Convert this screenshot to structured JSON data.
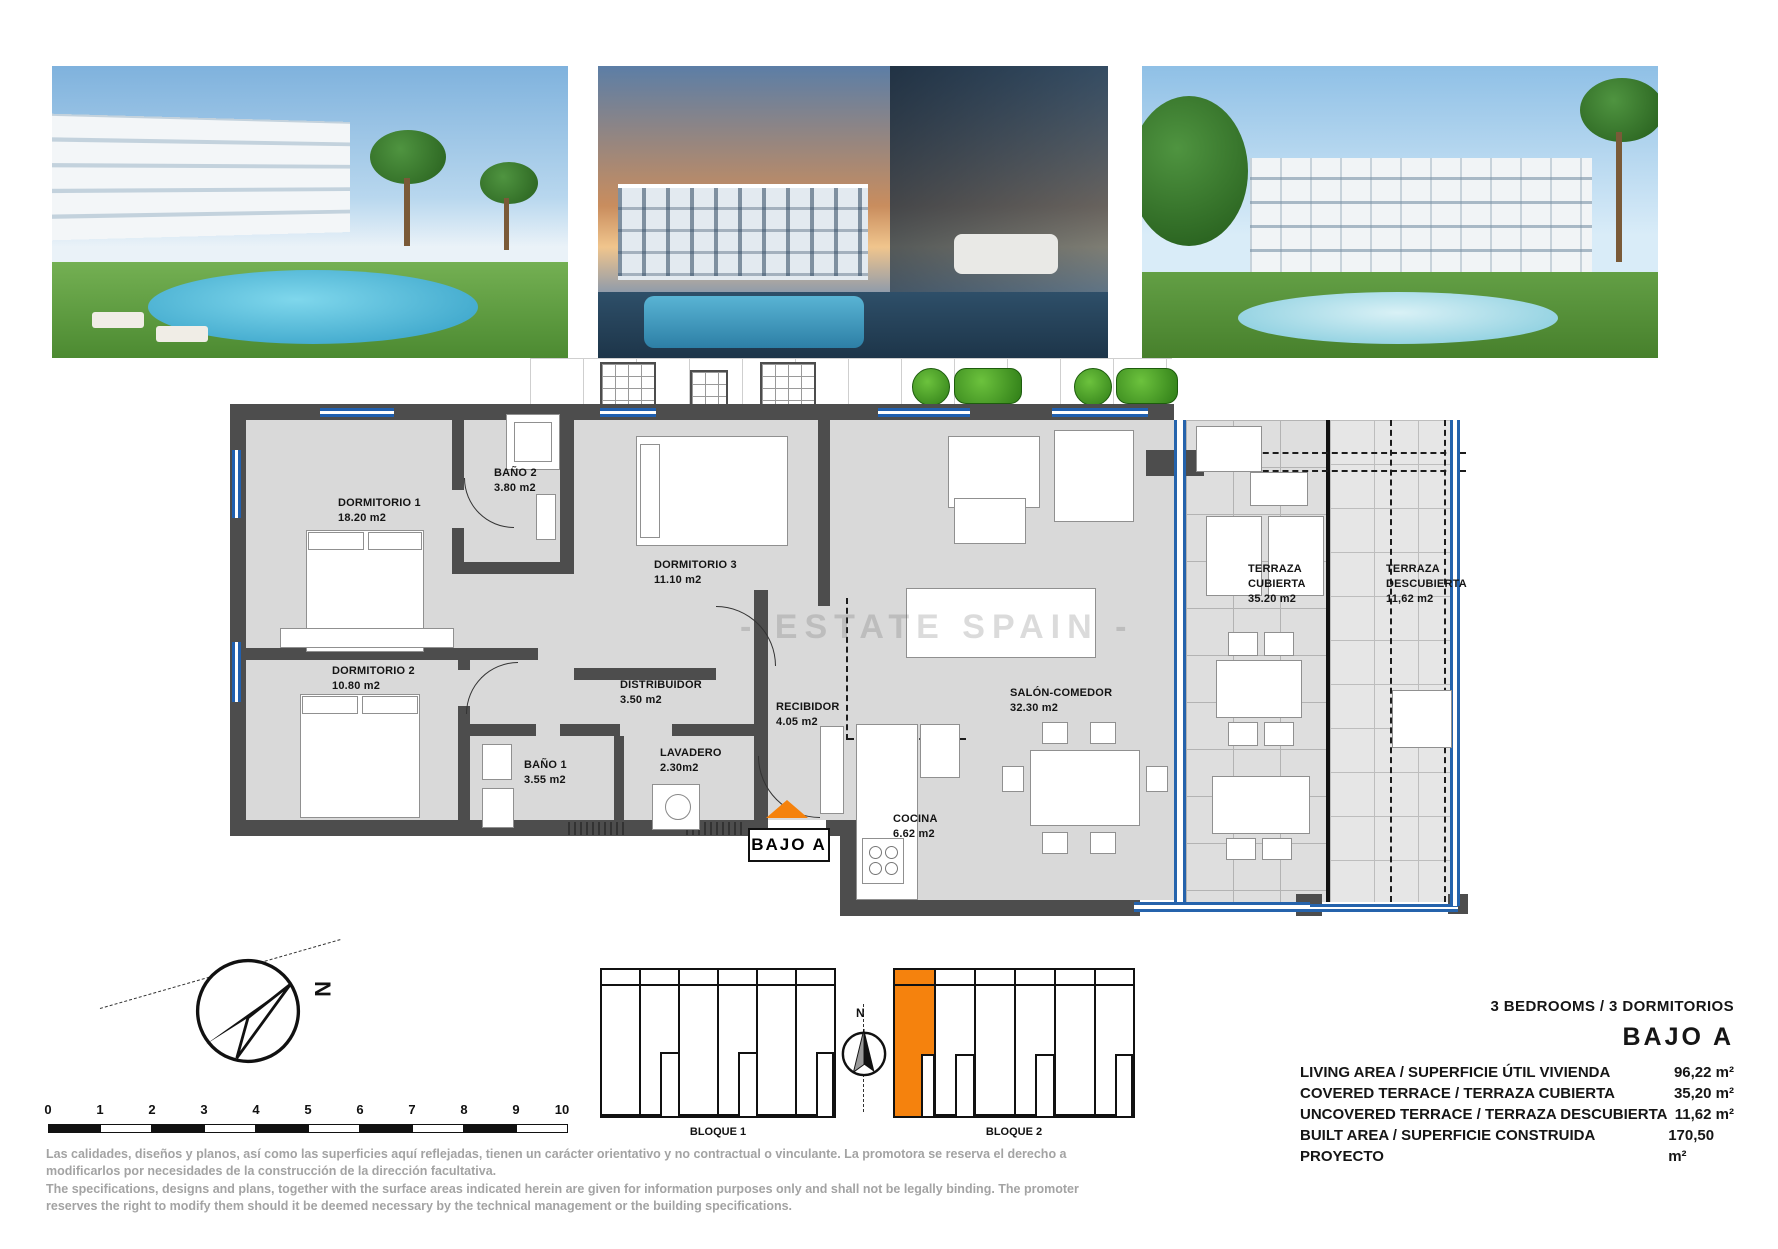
{
  "watermark": "- ESTATE SPAIN -",
  "floorplan": {
    "unit_label": "BAJO A",
    "rooms": [
      {
        "name": "DORMITORIO 1",
        "area": "18.20 m2"
      },
      {
        "name": "BAÑO 2",
        "area": "3.80 m2"
      },
      {
        "name": "DORMITORIO 3",
        "area": "11.10 m2"
      },
      {
        "name": "DORMITORIO 2",
        "area": "10.80 m2"
      },
      {
        "name": "DISTRIBUIDOR",
        "area": "3.50 m2"
      },
      {
        "name": "BAÑO 1",
        "area": "3.55 m2"
      },
      {
        "name": "LAVADERO",
        "area": "2.30m2"
      },
      {
        "name": "RECIBIDOR",
        "area": "4.05 m2"
      },
      {
        "name": "SALÓN-COMEDOR",
        "area": "32.30 m2"
      },
      {
        "name": "COCINA",
        "area": "6.62 m2"
      },
      {
        "name": "TERRAZA CUBIERTA",
        "area": "35.20 m2"
      },
      {
        "name": "TERRAZA DESCUBIERTA",
        "area": "11,62 m2"
      }
    ]
  },
  "compass": {
    "north": "N"
  },
  "scalebar": {
    "ticks": [
      "0",
      "1",
      "2",
      "3",
      "4",
      "5",
      "6",
      "7",
      "8",
      "9",
      "10"
    ]
  },
  "blocks": [
    {
      "label": "BLOQUE 1"
    },
    {
      "label": "BLOQUE 2"
    }
  ],
  "details": {
    "bedrooms": "3 BEDROOMS / 3 DORMITORIOS",
    "unit": "BAJO A",
    "rows": [
      {
        "label": "LIVING AREA / SUPERFICIE ÚTIL VIVIENDA",
        "value": "96,22 m²"
      },
      {
        "label": "COVERED TERRACE / TERRAZA CUBIERTA",
        "value": "35,20 m²"
      },
      {
        "label": "UNCOVERED TERRACE / TERRAZA DESCUBIERTA",
        "value": "11,62 m²"
      },
      {
        "label": "BUILT AREA / SUPERFICIE CONSTRUIDA PROYECTO",
        "value": "170,50 m²"
      }
    ]
  },
  "disclaimer": {
    "es": "Las calidades, diseños y planos, así como las superficies aquí reflejadas, tienen un carácter orientativo y no contractual o vinculante. La promotora se reserva el derecho a modificarlos por necesidades de la construcción de la dirección facultativa.",
    "en": "The specifications, designs and plans, together with the surface areas indicated herein are given for information purposes only and shall not be legally binding. The promoter reserves the right to modify them should it be deemed necessary by the technical management or the building specifications."
  },
  "colors": {
    "accent_orange": "#F5820D",
    "window_blue": "#2060B0",
    "wall_gray": "#4D4D4D"
  }
}
